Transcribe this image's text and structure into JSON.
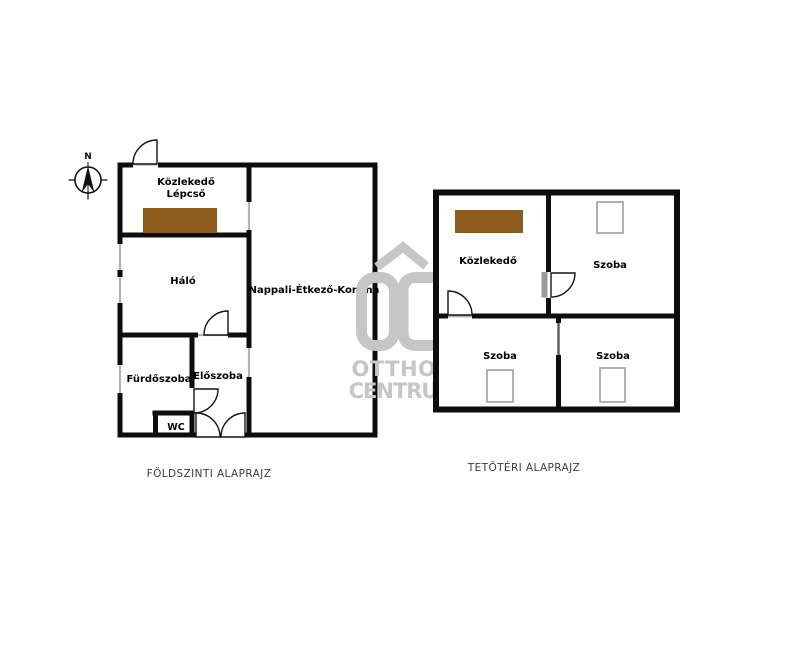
{
  "colors": {
    "stairs_brown": "#8c5a19",
    "watermark_gray": "#c6c6c6",
    "threshold_gray": "#b3b3b3",
    "open_door_gray": "#9a9a9a"
  },
  "compass": {
    "north_label": "N"
  },
  "ground_floor": {
    "caption": "FÖLDSZINTI ALAPRAJZ",
    "rooms": {
      "kozlekedo_line1": "Közlekedő",
      "kozlekedo_line2": "Lépcső",
      "halo": "Háló",
      "nappali": "Nappali-Étkező-Konyha",
      "furdoszoba": "Fürdőszoba",
      "eloszoba": "Előszoba",
      "wc": "WC"
    }
  },
  "attic": {
    "caption": "TETŐTÉRI ALAPRAJZ",
    "rooms": {
      "kozlekedo": "Közlekedő",
      "szoba_top": "Szoba",
      "szoba_bottom_left": "Szoba",
      "szoba_bottom_right": "Szoba"
    }
  },
  "watermark": {
    "logo_text": "OC",
    "line1": "OTTHON",
    "line2": "CENTRUM"
  }
}
